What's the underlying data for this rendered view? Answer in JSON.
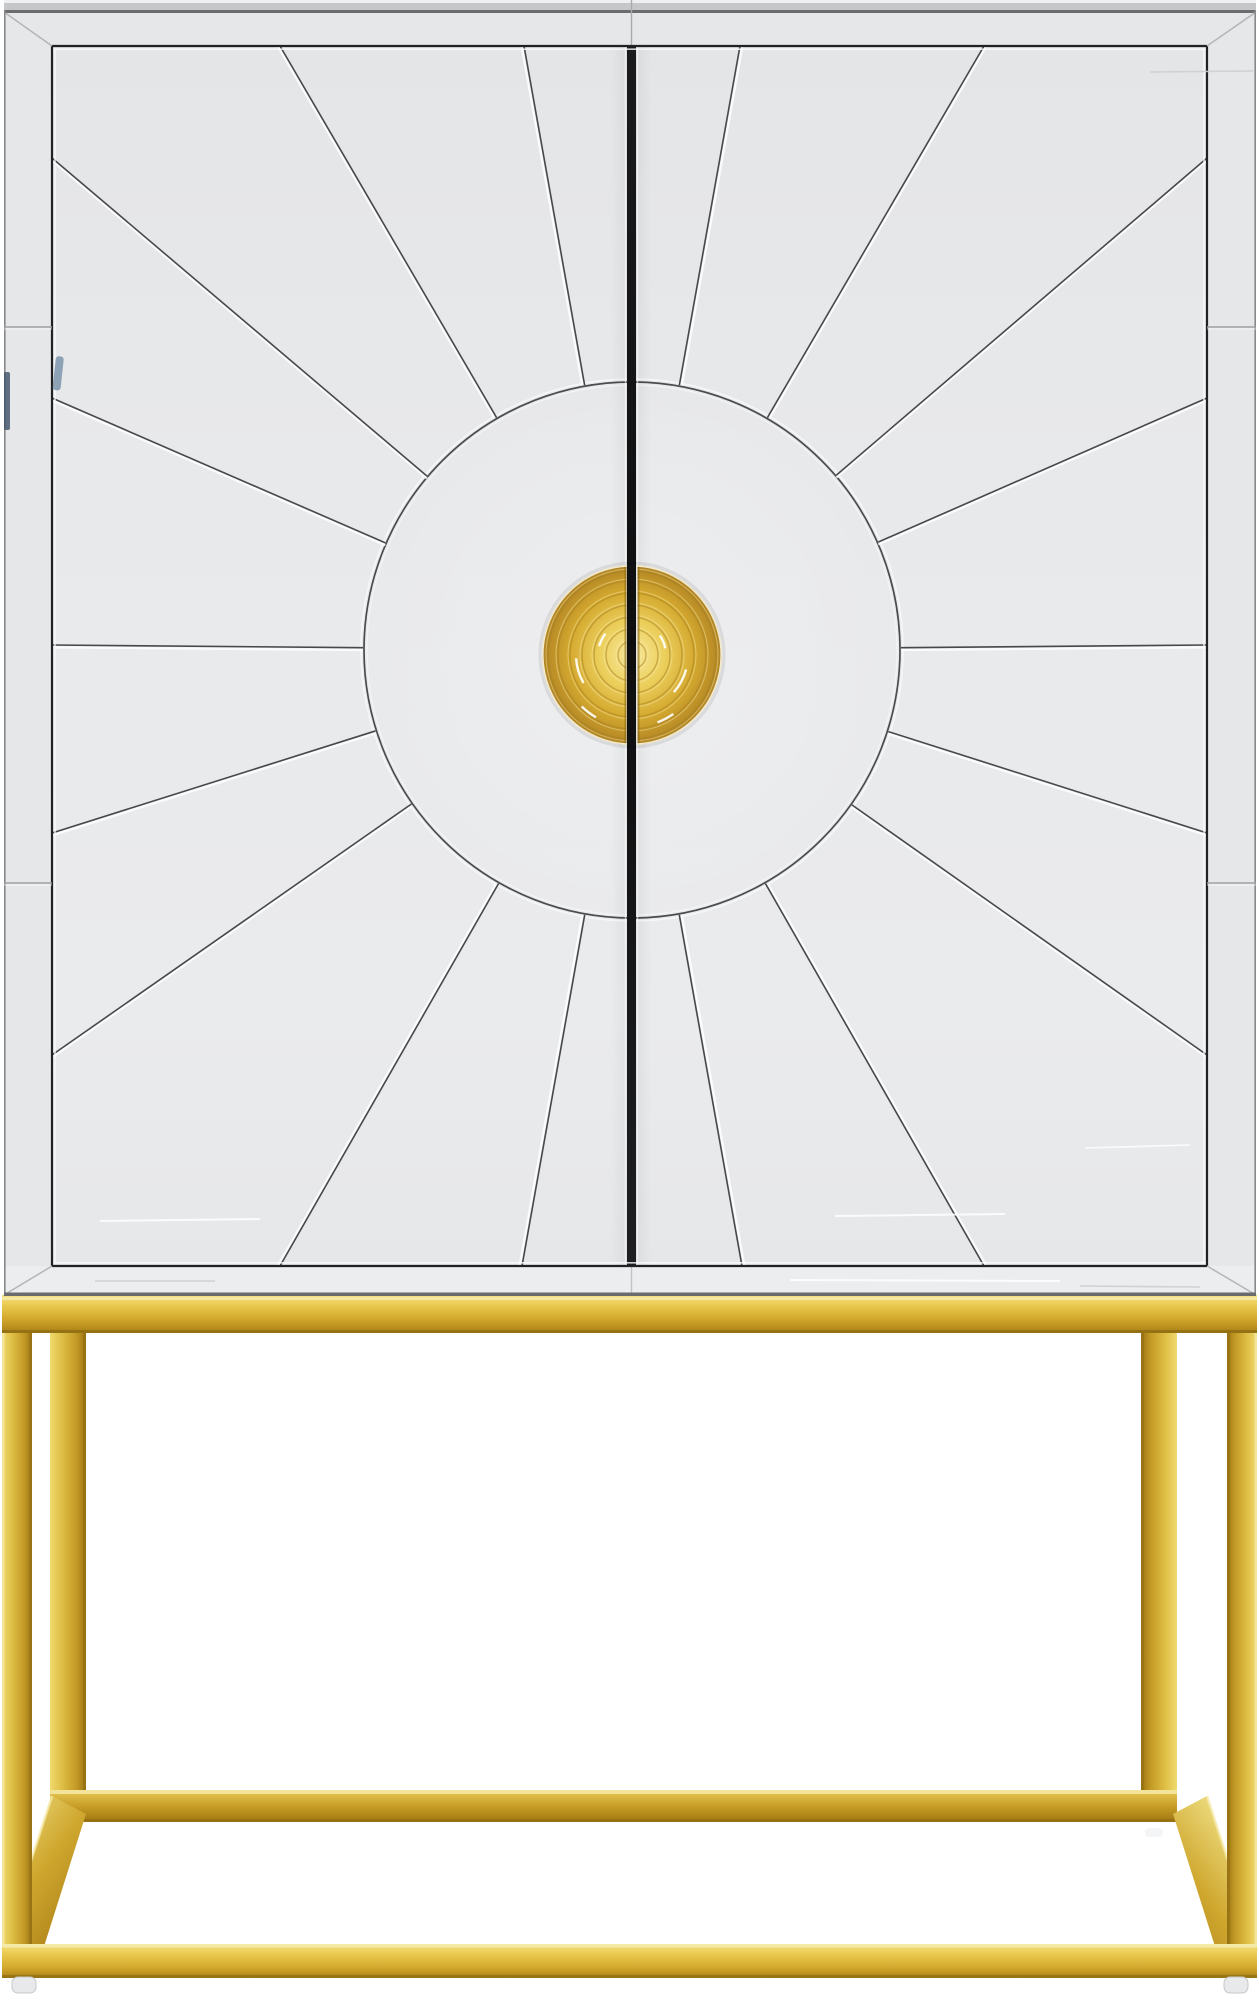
{
  "meta": {
    "type": "product-photo",
    "subject": "Art-deco sunburst mirrored bar cabinet with split gold disc handle on a polished brass cube base"
  },
  "canvas": {
    "w": 1259,
    "h": 2000,
    "background": "#ffffff"
  },
  "palette": {
    "mirrorFace": "#e8e9eb",
    "mirrorFrame": "#e6e7e9",
    "bottomStrip": "#ecedef",
    "topStripLight": "#eef0f1",
    "topStripMid": "#c6c7c9",
    "topStripDark": "#6b6c6e",
    "seamDark": "#212224",
    "seamLight": "#fafbfc",
    "rayLine": "#47484a",
    "arcLine": "#4b4c4e",
    "miter": "#b4b5b7",
    "outerEdge": "#87888a",
    "frameSeam": "#9fa0a2",
    "contactShadow": "#6a6b6d",
    "gapGradient": [
      "#1a1b1d",
      "#0f0f10",
      "#1e1f21"
    ],
    "blueStreak": "#7c95aa",
    "frameStreakBlue": "#3e5166",
    "scratchLight": "#ffffff",
    "scratchGray": "#cdced0",
    "goldKnob": [
      "#f7e9a0",
      "#ecd05e",
      "#d4a92f",
      "#b08324"
    ],
    "goldRailFront": [
      "#f4e184",
      "#eac94e",
      "#d2a82c",
      "#aa7f16"
    ],
    "goldRailBack": [
      "#e8ca58",
      "#c89e26",
      "#9f7612"
    ],
    "goldLeg": [
      "#f0d96e",
      "#ddbd43",
      "#c19824",
      "#9d7513"
    ],
    "goldDiag": [
      "#f2e48c",
      "#cfa72e",
      "#a87c15"
    ],
    "goldEdgeHighlight": "#f6ebae",
    "goldEdgeDark": "#8f6d12",
    "ringDark": "#a57d1e",
    "ringLight": "#f8ecae",
    "foot": "#e8e9eb",
    "footEdge": "#c6c7c9"
  },
  "cabinet": {
    "outer": {
      "x": 4,
      "y": 0,
      "w": 1252,
      "h": 1295
    },
    "topEdgeH": 12,
    "frameTopY": 12,
    "doorTop": 46,
    "doorBottom": 1266,
    "bottomStripBottom": 1295,
    "leftSeamX": 52,
    "rightSeamX": 1207,
    "gap": {
      "x1": 627,
      "x2": 636
    },
    "frameSeamsY": [
      327,
      883
    ],
    "sunburst": {
      "cx": 632,
      "cy": 650,
      "r": 268,
      "rayEndpoints": [
        [
          280,
          46
        ],
        [
          524,
          46
        ],
        [
          52,
          158
        ],
        [
          52,
          398
        ],
        [
          52,
          645
        ],
        [
          52,
          833
        ],
        [
          52,
          1055
        ],
        [
          280,
          1266
        ],
        [
          522,
          1266
        ],
        [
          740,
          46
        ],
        [
          984,
          46
        ],
        [
          1207,
          158
        ],
        [
          1207,
          398
        ],
        [
          1207,
          645
        ],
        [
          1207,
          833
        ],
        [
          1207,
          1055
        ],
        [
          742,
          1266
        ],
        [
          984,
          1266
        ]
      ]
    },
    "knob": {
      "cx": 632,
      "cy": 655,
      "r": 90,
      "leftEdge": 626.5,
      "rightEdge": 637.5,
      "rings": [
        14,
        26,
        38,
        50,
        62,
        74,
        84
      ]
    },
    "blueStreak": {
      "x": 56,
      "y": 356,
      "w": 8,
      "h": 34
    },
    "frameStreak": {
      "x": 4,
      "y": 372,
      "w": 6,
      "h": 58
    },
    "scratches": [
      {
        "x1": 100,
        "y1": 1221,
        "x2": 260,
        "y2": 1219,
        "c": "light",
        "w": 2
      },
      {
        "x1": 835,
        "y1": 1216,
        "x2": 1005,
        "y2": 1214,
        "c": "light",
        "w": 2
      },
      {
        "x1": 1085,
        "y1": 1148,
        "x2": 1190,
        "y2": 1145,
        "c": "light",
        "w": 1.6
      },
      {
        "x1": 95,
        "y1": 1281,
        "x2": 215,
        "y2": 1281,
        "c": "gray",
        "w": 1.6
      },
      {
        "x1": 790,
        "y1": 1280,
        "x2": 1060,
        "y2": 1281,
        "c": "light",
        "w": 2
      },
      {
        "x1": 1080,
        "y1": 1286,
        "x2": 1200,
        "y2": 1287,
        "c": "gray",
        "w": 1.6
      },
      {
        "x1": 1150,
        "y1": 72,
        "x2": 1253,
        "y2": 71,
        "c": "gray",
        "w": 1.4
      }
    ]
  },
  "base": {
    "topRail": {
      "x": 2,
      "y": 1295,
      "w": 1255,
      "h": 38
    },
    "legsTop": 1333,
    "frontLegs": [
      {
        "x": 2,
        "w": 30
      },
      {
        "x": 1227,
        "w": 30
      }
    ],
    "backLegs": [
      {
        "x": 50,
        "w": 36
      },
      {
        "x": 1141,
        "w": 36
      }
    ],
    "backLegBottom": 1800,
    "backRail": {
      "x": 50,
      "y": 1790,
      "w": 1127,
      "h": 32
    },
    "frontRail": {
      "x": 2,
      "y": 1944,
      "w": 1255,
      "h": 34
    },
    "leftDiag": [
      [
        52,
        1796
      ],
      [
        86,
        1814
      ],
      [
        34,
        1978
      ],
      [
        2,
        1950
      ]
    ],
    "rightDiag": [
      [
        1207,
        1796
      ],
      [
        1173,
        1814
      ],
      [
        1225,
        1978
      ],
      [
        1257,
        1950
      ]
    ],
    "feet": [
      {
        "x": 12,
        "y": 1977,
        "w": 24,
        "h": 16
      },
      {
        "x": 1224,
        "y": 1977,
        "w": 24,
        "h": 16
      }
    ],
    "backFeet": [
      {
        "x": 54,
        "y": 1820,
        "w": 18,
        "h": 9
      },
      {
        "x": 1145,
        "y": 1820,
        "w": 18,
        "h": 9
      }
    ]
  }
}
